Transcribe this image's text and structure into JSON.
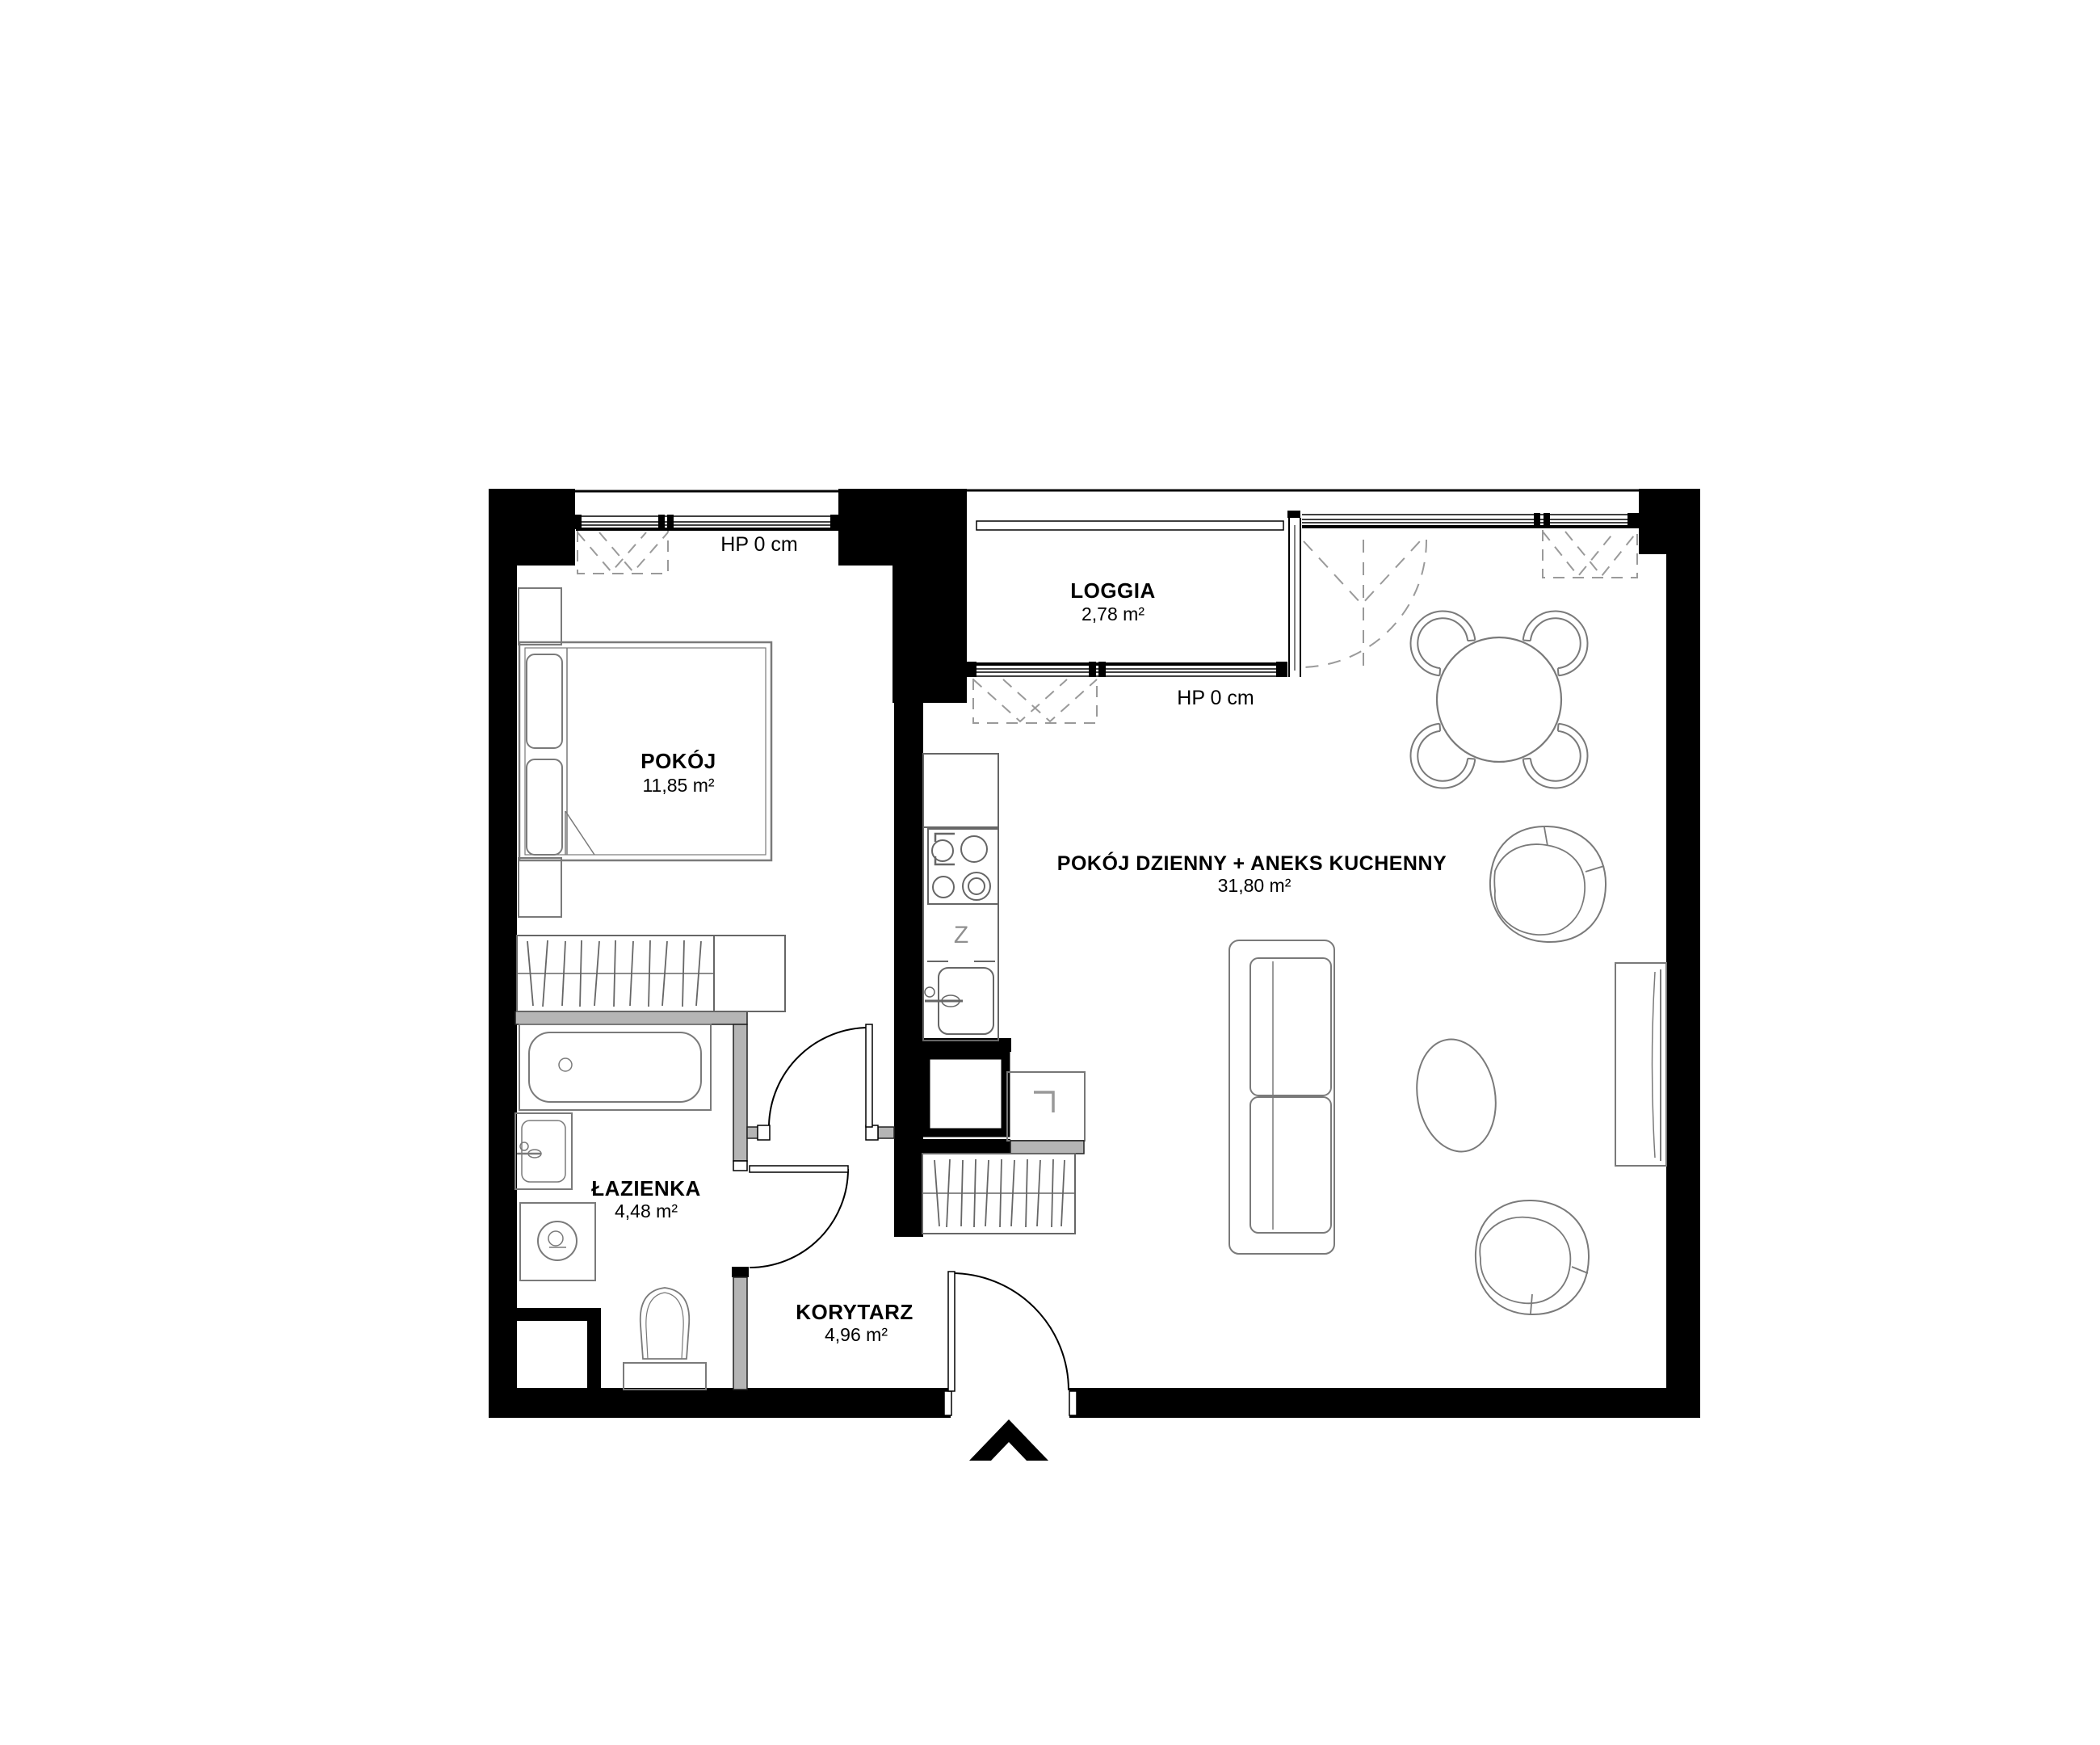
{
  "plan": {
    "rooms": [
      {
        "id": "pokoj",
        "name": "POKÓJ",
        "area": "11,85 m²"
      },
      {
        "id": "loggia",
        "name": "LOGGIA",
        "area": "2,78 m²"
      },
      {
        "id": "pokoj-dzienny",
        "name": "POKÓJ DZIENNY + ANEKS KUCHENNY",
        "area": "31,80 m²"
      },
      {
        "id": "lazienka",
        "name": "ŁAZIENKA",
        "area": "4,48 m²"
      },
      {
        "id": "korytarz",
        "name": "KORYTARZ",
        "area": "4,96 m²"
      }
    ],
    "window_sill_labels": [
      {
        "id": "hp-bedroom",
        "text": "HP 0 cm"
      },
      {
        "id": "hp-loggia",
        "text": "HP 0 cm"
      }
    ],
    "kitchen_symbol": "Z",
    "colors": {
      "wall": "#000000",
      "partition": "#b5b5b5",
      "furniture_line": "#7a7a7a",
      "dashed_opening": "#9a9a9a",
      "background": "#ffffff"
    }
  }
}
